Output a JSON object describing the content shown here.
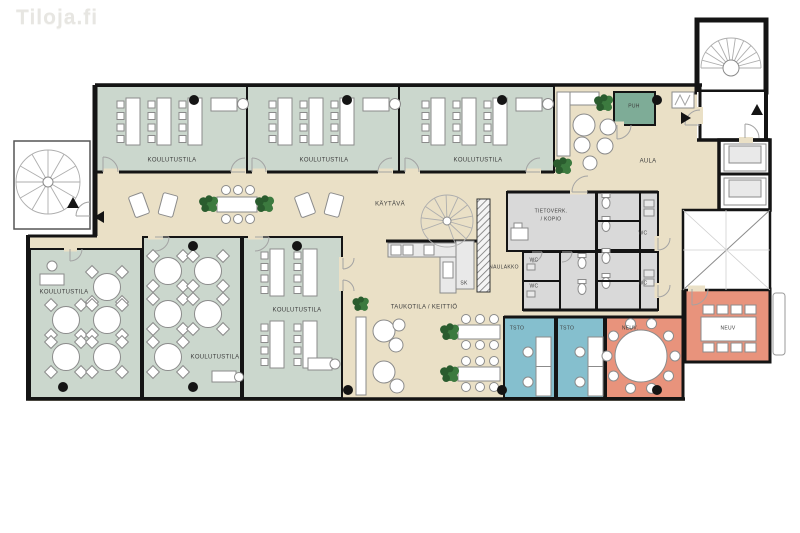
{
  "watermark": "Tiloja.fi",
  "palette": {
    "floor_tan": "#EAE0C6",
    "training_green": "#CBD7CD",
    "office_blue": "#85BFCE",
    "meeting_salmon": "#E8937C",
    "phone_green": "#7EAC97",
    "service_gray": "#D9D9D9",
    "wall_black": "#141414",
    "plant_green": "#3C7A3F"
  },
  "rooms": {
    "training": "KOULUTUSTILA",
    "corridor": "KÄYTÄVÄ",
    "lobby": "AULA",
    "phone_booth": "PUH",
    "network_room_line1": "TIETOVERK.",
    "network_room_line2": "/ KOPIO",
    "toilet": "WC",
    "coat_rack": "NAULAKKO",
    "cleaning_closet": "SK",
    "break_kitchen": "TAUKOTILA / KEITTIÖ",
    "office": "TSTO",
    "meeting": "NEUV.",
    "meeting_table": "NEUV"
  }
}
